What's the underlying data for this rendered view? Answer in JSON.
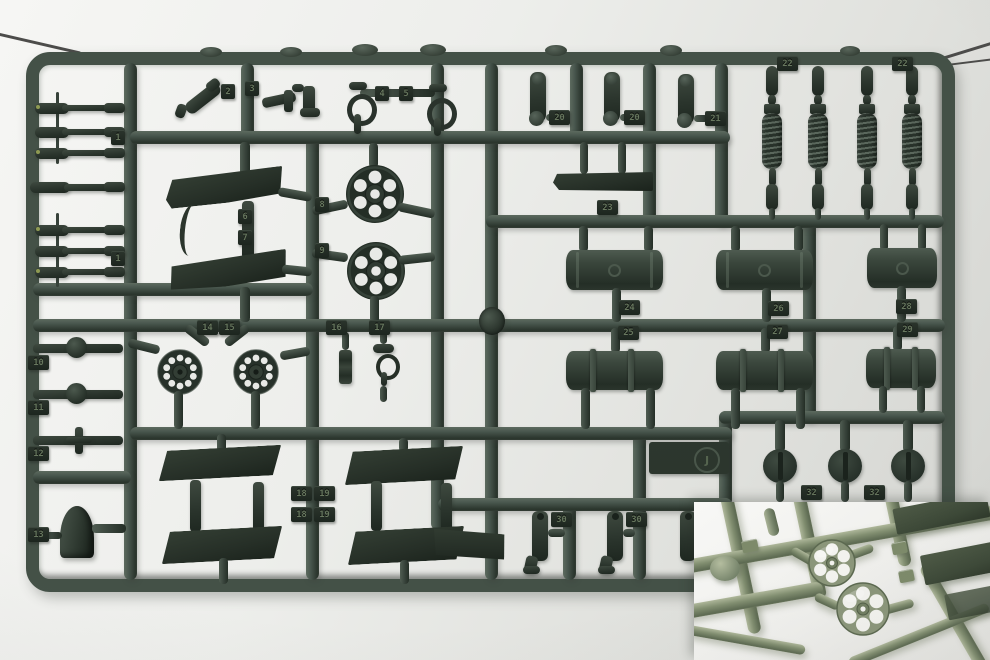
{
  "scene": {
    "description": "Photograph of a dark-green injection-molded plastic model kit parts sprue suspended on thin wires, with a close-up inset photo overlaid in the bottom-right corner",
    "sprue_letter": "J"
  },
  "colors": {
    "plastic_mid": "#46544b",
    "plastic_dark": "#242e26",
    "plastic_highlight": "#5d6a5f",
    "tag_background": "#232c24",
    "inset_plastic": "#818e70",
    "backdrop": "#e8e9e6"
  },
  "tags": [
    "1",
    "2",
    "3",
    "4",
    "5",
    "20",
    "20",
    "21",
    "22",
    "22",
    "6",
    "7",
    "8",
    "9",
    "1",
    "23",
    "24",
    "25",
    "26",
    "27",
    "28",
    "29",
    "10",
    "11",
    "12",
    "13",
    "14",
    "15",
    "16",
    "17",
    "18",
    "19",
    "18",
    "19",
    "30",
    "30",
    "32",
    "32"
  ]
}
